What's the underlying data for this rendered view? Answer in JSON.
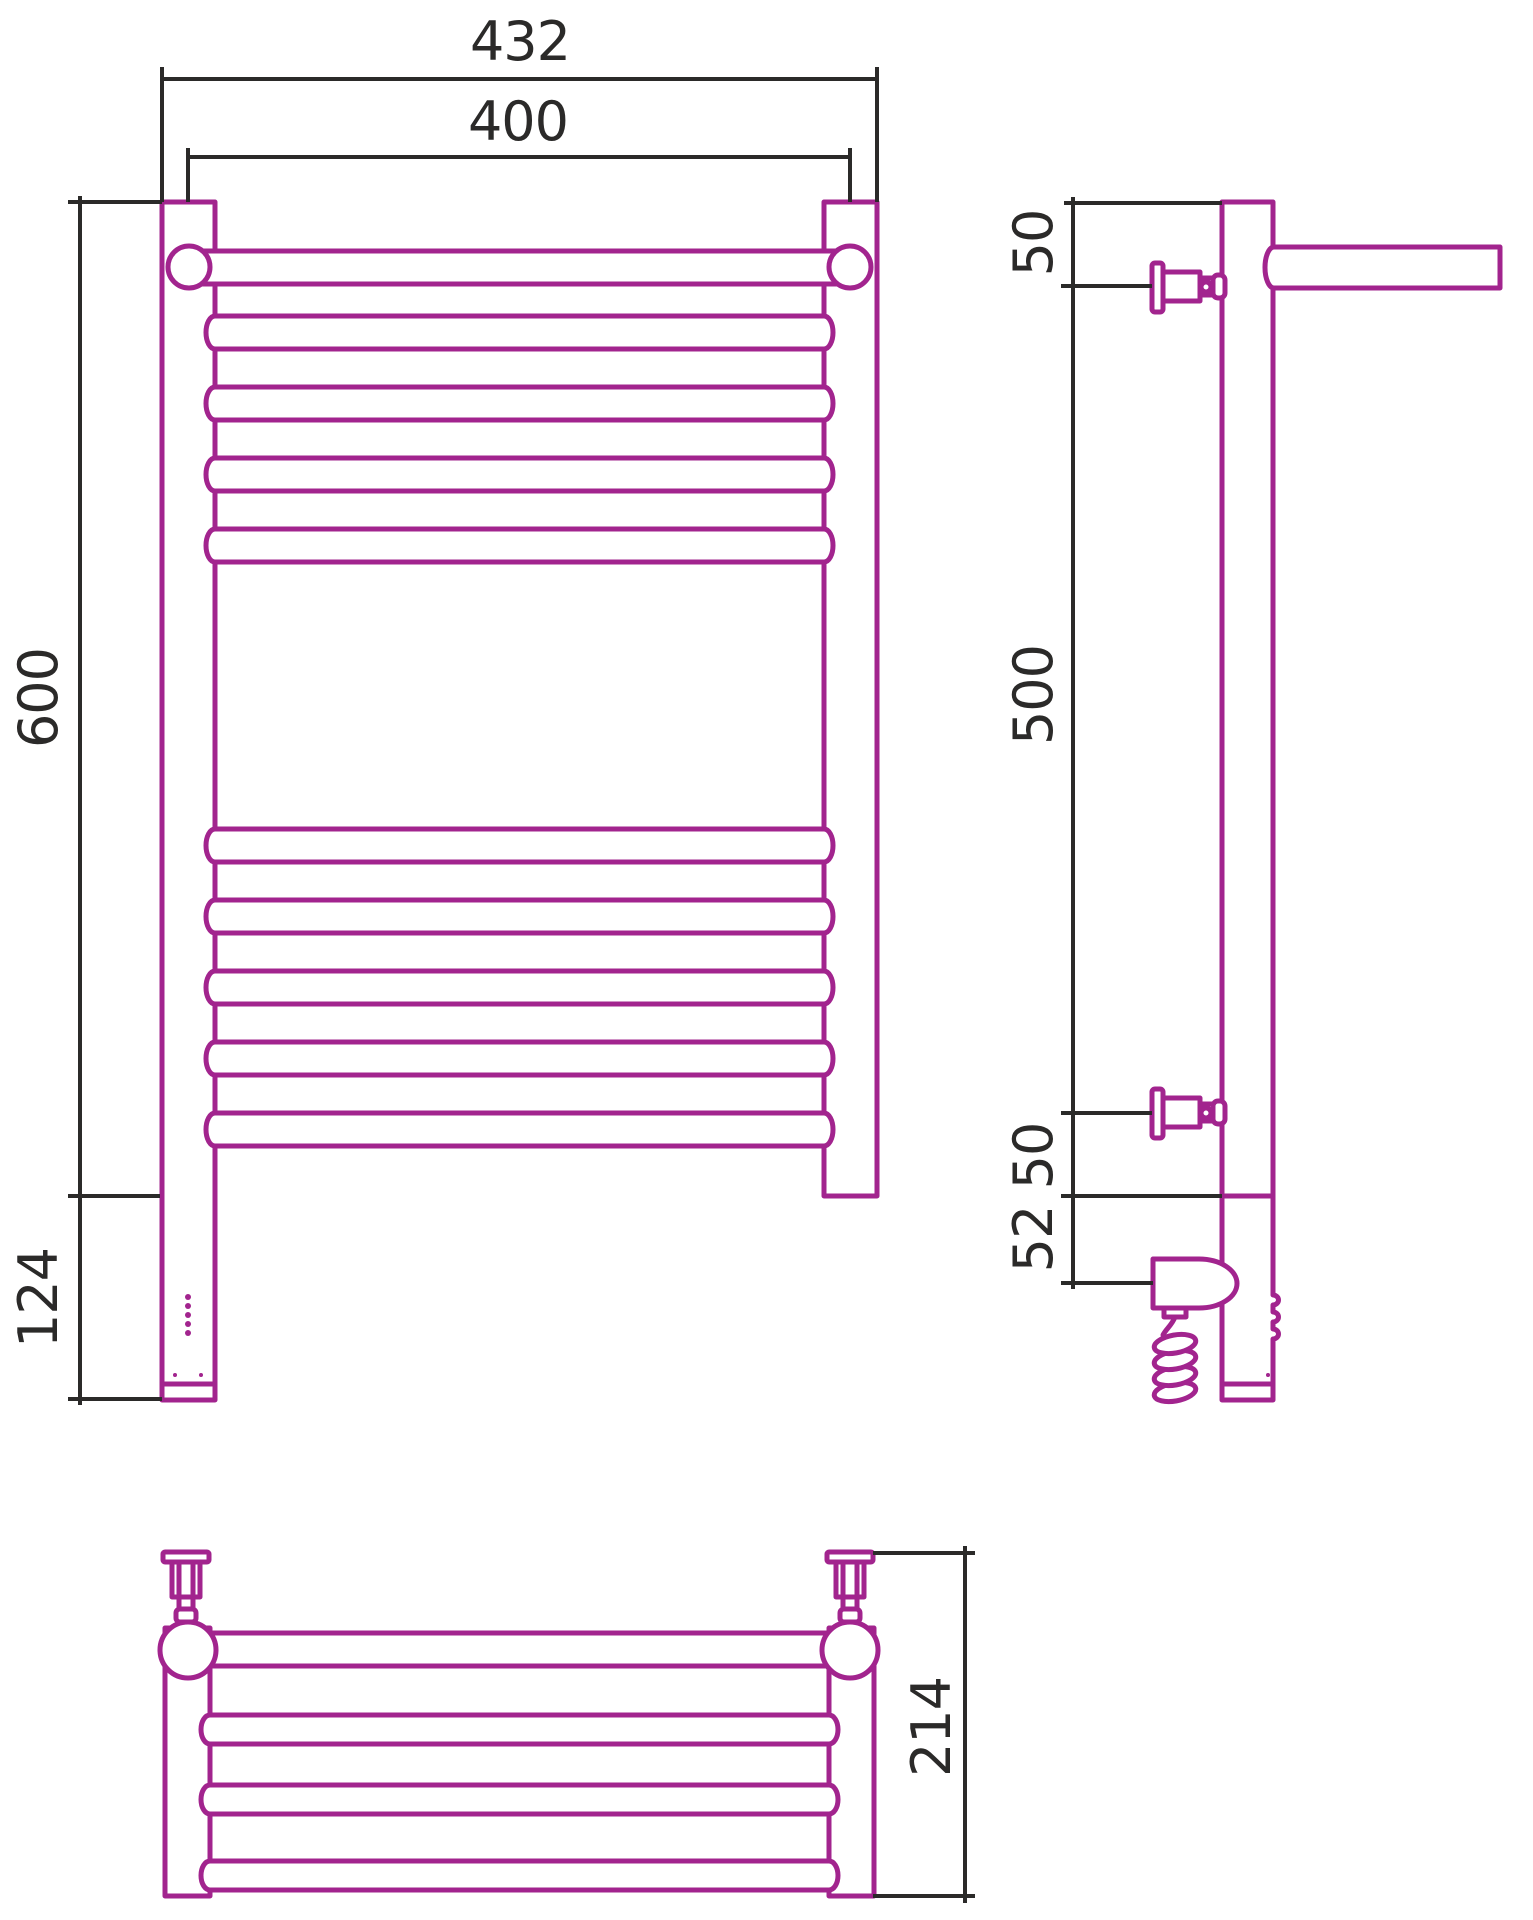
{
  "colors": {
    "outline": "#A2248E",
    "dims": "#2B2A29",
    "bg": "#FFFFFF"
  },
  "front_view": {
    "dim_width_overall": "432",
    "dim_width_axes": "400",
    "dim_height": "600",
    "dim_electric_height": "124"
  },
  "side_view": {
    "dim_top_offset": "50",
    "dim_span": "500",
    "dim_bottom_offset": "50",
    "dim_element_offset": "52"
  },
  "top_view": {
    "dim_depth": "214"
  }
}
